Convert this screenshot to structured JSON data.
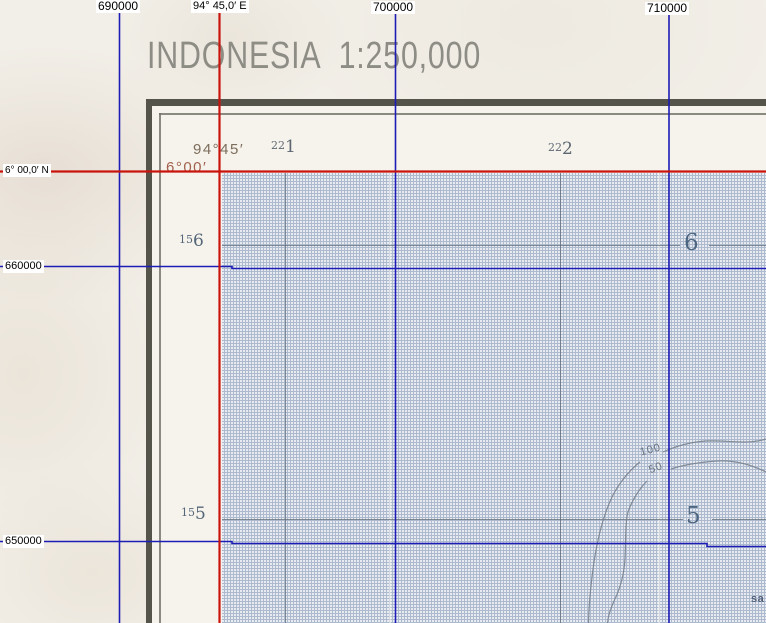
{
  "viewer": {
    "top_labels": [
      {
        "text": "690000"
      },
      {
        "text": "94° 45,0′ E"
      },
      {
        "text": "700000"
      },
      {
        "text": "710000"
      }
    ],
    "left_labels": [
      {
        "text": "6° 00,0′ N"
      },
      {
        "text": "660000"
      },
      {
        "text": "650000"
      }
    ],
    "line_colors": {
      "grid_blue": "#1d1cb5",
      "graticule_red": "#c9140e"
    }
  },
  "map_sheet": {
    "title": "INDONESIA 1:250,000",
    "corner": {
      "longitude": "94°45′",
      "latitude": "6°00′"
    },
    "easting_labels": [
      {
        "small": "22",
        "big": "1"
      },
      {
        "small": "22",
        "big": "2"
      }
    ],
    "northing_labels": [
      {
        "small": "15",
        "big": "6"
      },
      {
        "small": "15",
        "big": "5"
      }
    ],
    "sea_row_labels": [
      "6",
      "5"
    ],
    "contours": [
      {
        "label": "100"
      },
      {
        "label": "50"
      }
    ],
    "place_name_fragment": "sa",
    "colors": {
      "sea": "#adb9cc",
      "paper": "#f2efe8",
      "frame": "#54544b",
      "grid_gray": "#5c6672",
      "sea_numeral": "#4c6580",
      "corner_longitude": "#7c6d5c",
      "corner_latitude": "#a2614e"
    }
  }
}
